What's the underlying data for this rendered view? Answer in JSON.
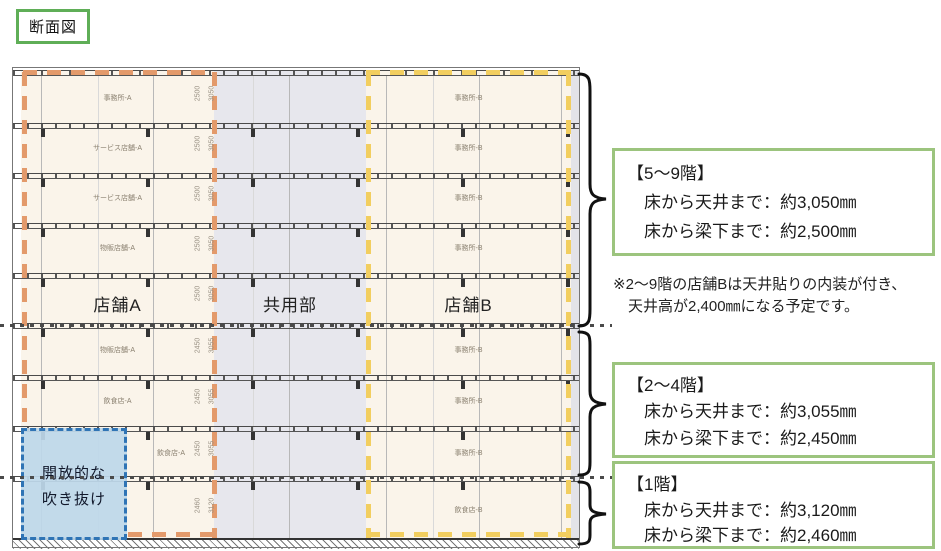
{
  "title": "断面図",
  "drawing": {
    "section_labels": {
      "store_a": "店舗A",
      "common": "共用部",
      "store_b": "店舗B"
    },
    "atrium": {
      "line1": "開放的な",
      "line2": "吹き抜け"
    },
    "floors": [
      {
        "a": "事務所-A",
        "b": "事務所-B",
        "dim_c": "2500",
        "dim_h": "3050"
      },
      {
        "a": "サービス店舗-A",
        "b": "事務所-B",
        "dim_c": "2500",
        "dim_h": "3050"
      },
      {
        "a": "サービス店舗-A",
        "b": "事務所-B",
        "dim_c": "2500",
        "dim_h": "3050"
      },
      {
        "a": "物販店舗-A",
        "b": "事務所-B",
        "dim_c": "2500",
        "dim_h": "3050"
      },
      {
        "a": "",
        "b": "",
        "dim_c": "2500",
        "dim_h": "3050"
      },
      {
        "a": "物販店舗-A",
        "b": "事務所-B",
        "dim_c": "2450",
        "dim_h": "3055"
      },
      {
        "a": "飲食店-A",
        "b": "事務所-B",
        "dim_c": "2450",
        "dim_h": "3055"
      },
      {
        "a": "飲食店-A",
        "b": "事務所-B",
        "dim_c": "2450",
        "dim_h": "3055"
      },
      {
        "a": "",
        "b": "飲食店-B",
        "dim_c": "2460",
        "dim_h": "3120"
      }
    ],
    "colors": {
      "store_a_outline": "#E39A6B",
      "store_b_outline": "#F2CE5F",
      "atrium_fill": "#BDD7EA",
      "atrium_border": "#2F74B5",
      "common_fill": "#E7E7ED",
      "annotation_border": "#9CC47E",
      "title_border": "#5FAE57"
    }
  },
  "annotations": [
    {
      "heading": "【5〜9階】",
      "line1": "床から天井まで：約3,050㎜",
      "line2": "床から梁下まで：約2,500㎜"
    },
    {
      "heading": "【2〜4階】",
      "line1": "床から天井まで：約3,055㎜",
      "line2": "床から梁下まで：約2,450㎜"
    },
    {
      "heading": "【1階】",
      "line1": "床から天井まで：約3,120㎜",
      "line2": "床から梁下まで：約2,460㎜"
    }
  ],
  "note": {
    "line1": "※2〜9階の店舗Bは天井貼りの内装が付き、",
    "line2": "天井高が2,400㎜になる予定です。"
  }
}
